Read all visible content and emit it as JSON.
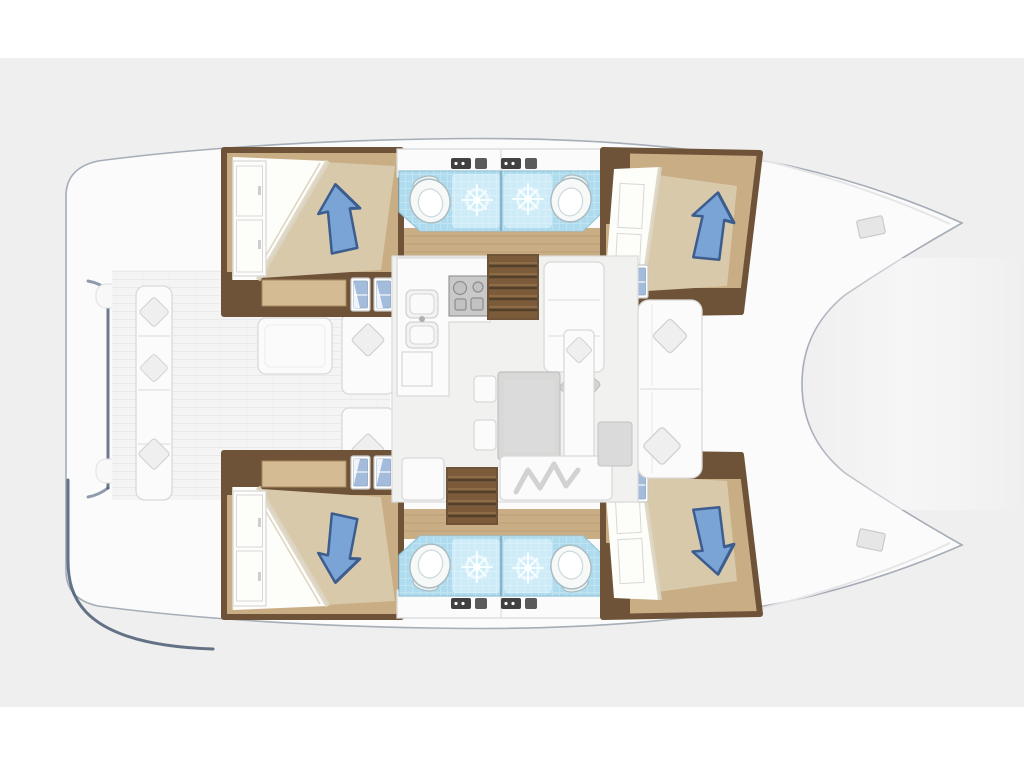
{
  "app": {
    "type": "boat-layout-diagram",
    "subject": "catamaran-interior-deck-plan",
    "orientation": "bow-right",
    "visible_text": "",
    "cabins_count": 4,
    "bathrooms_count": 4,
    "companionways_count": 2
  },
  "canvas": {
    "width": 1024,
    "height": 767
  },
  "palette": {
    "bg_page": "#ffffff",
    "bg_mat": "#efefef",
    "hull_fill": "#fbfbfc",
    "hull_stroke": "#a6adb7",
    "hull_seam": "#e6e6e8",
    "navy_accent": "#4a5a74",
    "deck_floor": "#f4f4f4",
    "deck_line": "#eaeaea",
    "furniture_white": "#fbfbfb",
    "furniture_stroke": "#d9d9d9",
    "cushion_gray": "#efefef",
    "cushion_stroke": "#d2d2d2",
    "wood_floor": "#c9ad85",
    "wood_seam": "#b4946a",
    "wood_dark": "#6f5339",
    "dresser_wood": "#d4bb94",
    "stair_fill": "#7c5b3b",
    "stair_line": "#53402a",
    "mattress": "#d8c9ab",
    "sheet": "#fdfdfa",
    "sheet_seam": "#ddd5c2",
    "wardrobe_stroke": "#d8d8d8",
    "pillow_blue": "#7aa4d6",
    "pillow_blue_dark": "#3c5d8e",
    "tile_blue": "#aedcee",
    "tile_blue_light": "#d3eef9",
    "tile_stroke": "#93c3d6",
    "tile_divider": "#85b4c9",
    "spark_white": "#f4feff",
    "porcelain": "#f7f9f9",
    "porcelain_stroke": "#a9bcc2",
    "fixture_dark": "#414141",
    "appliance_gray": "#c9c9c9",
    "appliance_stroke": "#979797",
    "table_gray": "#d8d8d6",
    "table_stroke": "#c0c0c0",
    "blanket_gray": "#d2d2d2",
    "hatch_frame": "#c8c8c8",
    "hatch_blue": "#a3bcdb"
  },
  "rooms": {
    "boat": "catamaran-deck-plan",
    "port_hull": "port-hull-interior",
    "starboard_hull": "starboard-hull-interior",
    "aft_cabin": "aft-double-cabin",
    "fwd_cabin": "forward-double-cabin",
    "bathrooms": "twin-shower-rooms-with-wc",
    "salon": "main-salon-dinette",
    "galley": "galley-sink-stove",
    "aft_cockpit": "aft-cockpit-seating",
    "fwd_cockpit": "forward-cockpit-seating",
    "foredeck": "foredeck-trampoline",
    "companionway": "companionway-steps",
    "transom": "transom-swim-steps"
  }
}
